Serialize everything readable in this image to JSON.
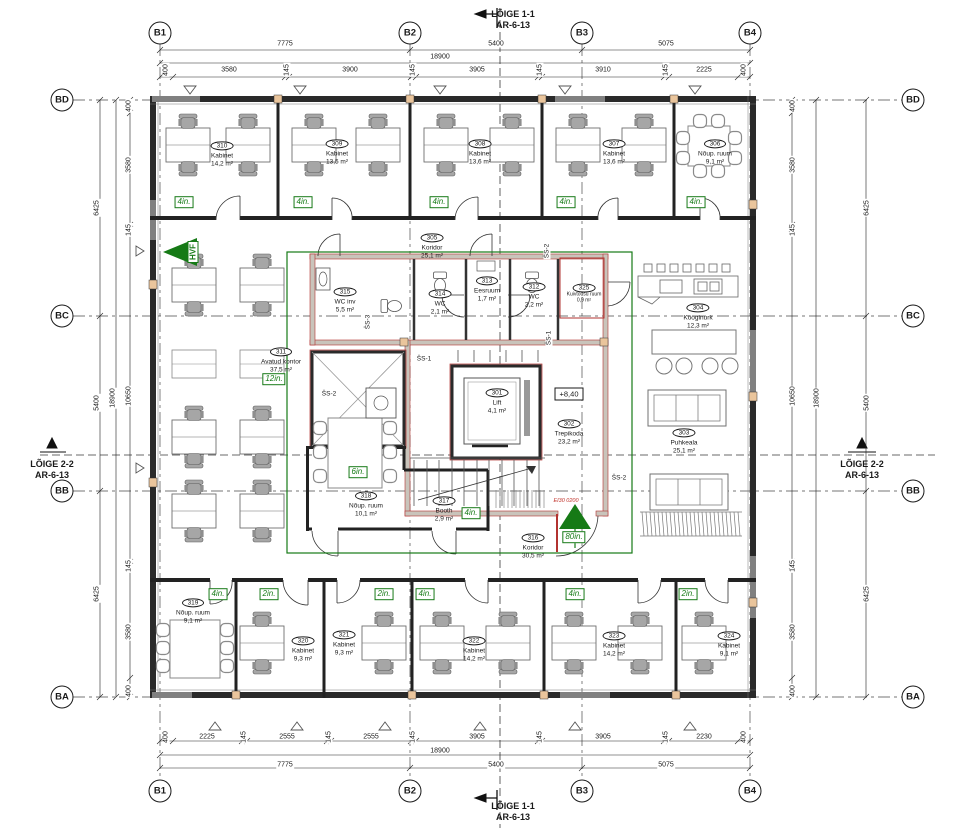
{
  "sections": {
    "s11_line1": "LÕIGE 1-1",
    "s11_line2": "AR-6-13",
    "s22_line1": "LÕIGE 2-2",
    "s22_line2": "AR-6-13"
  },
  "grid": {
    "cols": [
      "B1",
      "B2",
      "B3",
      "B4"
    ],
    "rows": [
      "BD",
      "BC",
      "BB",
      "BA"
    ]
  },
  "dims": {
    "top_span": [
      "7775",
      "5400",
      "5075"
    ],
    "top_total": "18900",
    "top_detail": [
      "400",
      "3580",
      "145",
      "3900",
      "145",
      "3905",
      "145",
      "3910",
      "145",
      "2225",
      "400"
    ],
    "bottom_detail": [
      "400",
      "2225",
      "145",
      "2555",
      "145",
      "2555",
      "145",
      "3905",
      "145",
      "3905",
      "145",
      "2230",
      "400"
    ],
    "bottom_total": "18900",
    "bottom_span": [
      "7775",
      "5400",
      "5075"
    ],
    "left_outer": [
      "6425",
      "5400",
      "6425"
    ],
    "left_total": "18900",
    "left_detail": [
      "400",
      "3580",
      "145",
      "10650",
      "145",
      "3580",
      "400"
    ],
    "right_outer": [
      "6425",
      "5400",
      "6425"
    ],
    "right_total": "18900",
    "right_detail": [
      "400",
      "3580",
      "145",
      "10650",
      "145",
      "3580",
      "400"
    ]
  },
  "rooms": [
    {
      "id": "310",
      "name": "Kabinet",
      "area": "14,2 m²"
    },
    {
      "id": "309",
      "name": "Kabinet",
      "area": "13,5 m²"
    },
    {
      "id": "308",
      "name": "Kabinet",
      "area": "13,6 m²"
    },
    {
      "id": "307",
      "name": "Kabinet",
      "area": "13,6 m²"
    },
    {
      "id": "306",
      "name": "Nõup. ruum",
      "area": "9,1 m²"
    },
    {
      "id": "305",
      "name": "Koridor",
      "area": "25,1 m²"
    },
    {
      "id": "311",
      "name": "Avatud kontor",
      "area": "37,5 m²"
    },
    {
      "id": "315",
      "name": "WC inv",
      "area": "5,5 m²"
    },
    {
      "id": "314",
      "name": "WC",
      "area": "2,1 m²"
    },
    {
      "id": "313",
      "name": "Eesruum",
      "area": "1,7 m²"
    },
    {
      "id": "312",
      "name": "WC",
      "area": "2,2 m²"
    },
    {
      "id": "325",
      "name": "Kuivtõusu ruum",
      "area": "0,9 m²"
    },
    {
      "id": "304",
      "name": "Kööginurk",
      "area": "12,3 m²"
    },
    {
      "id": "303",
      "name": "Puhkeala",
      "area": "25,1 m²"
    },
    {
      "id": "301",
      "name": "Lift",
      "area": "4,1 m²"
    },
    {
      "id": "302",
      "name": "Trepikoda",
      "area": "23,2 m²"
    },
    {
      "id": "318",
      "name": "Nõup. ruum",
      "area": "10,1 m²"
    },
    {
      "id": "317",
      "name": "Booth",
      "area": "2,9 m²"
    },
    {
      "id": "316",
      "name": "Koridor",
      "area": "30,5 m²"
    },
    {
      "id": "319",
      "name": "Nõup. ruum",
      "area": "9,1 m²"
    },
    {
      "id": "320",
      "name": "Kabinet",
      "area": "9,3 m²"
    },
    {
      "id": "321",
      "name": "Kabinet",
      "area": "9,3 m²"
    },
    {
      "id": "322",
      "name": "Kabinet",
      "area": "14,2 m²"
    },
    {
      "id": "323",
      "name": "Kabinet",
      "area": "14,2 m²"
    },
    {
      "id": "324",
      "name": "Kabinet",
      "area": "9,1 m²"
    }
  ],
  "tags": [
    "4in.",
    "4in.",
    "4in.",
    "4in.",
    "4in.",
    "12in.",
    "6in.",
    "4in.",
    "80in.",
    "4in.",
    "2in.",
    "2in.",
    "4in.",
    "4in.",
    "2in."
  ],
  "markers": {
    "hvf": "HVF",
    "level": "+8,40",
    "fire_door": "EI30 0200",
    "shaft_labels": [
      "ŠS-1",
      "ŠS-2",
      "ŠS-3"
    ]
  }
}
